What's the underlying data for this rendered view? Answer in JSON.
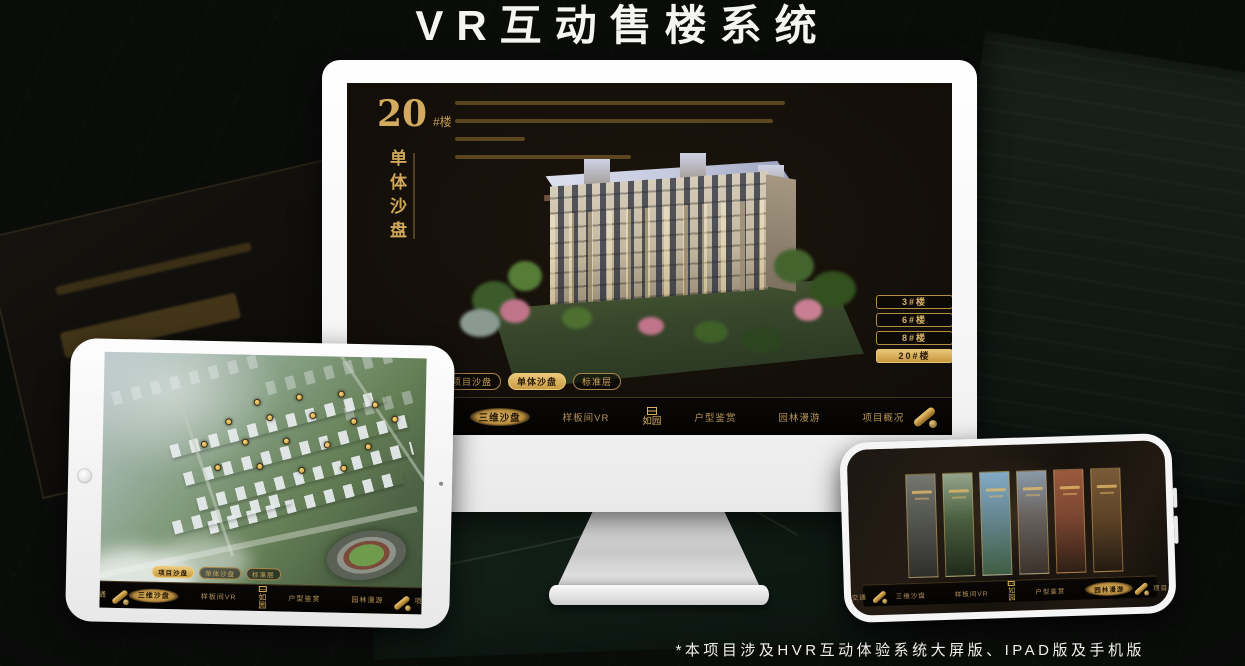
{
  "page": {
    "title": "VR互动售楼系统",
    "footnote": "*本项目涉及HVR互动体验系统大屏版、IPAD版及手机版"
  },
  "colors": {
    "gold": "#cfa95f",
    "gold_active": "#e3b964",
    "background": "#0a0c0a",
    "screen_dark": "#15100a"
  },
  "nav": {
    "logo": "如园",
    "subtabs": [
      "项目沙盘",
      "单体沙盘",
      "标准层"
    ],
    "items": [
      "区位交通",
      "三维沙盘",
      "样板间VR",
      "户型鉴赏",
      "园林漫游",
      "项目概况"
    ]
  },
  "desktop": {
    "headline_number": "20",
    "headline_unit": "#楼",
    "headline_subtitle": "单体沙盘",
    "active_subtab": "单体沙盘",
    "active_menu_item": "三维沙盘",
    "building_buttons": [
      {
        "label": "3#楼",
        "active": false
      },
      {
        "label": "6#楼",
        "active": false
      },
      {
        "label": "8#楼",
        "active": false
      },
      {
        "label": "20#楼",
        "active": true
      }
    ]
  },
  "tablet": {
    "active_subtab": "项目沙盘",
    "active_menu_item": "三维沙盘"
  },
  "phone": {
    "active_menu_item": "园林漫游",
    "gallery_panel_count": 6
  }
}
